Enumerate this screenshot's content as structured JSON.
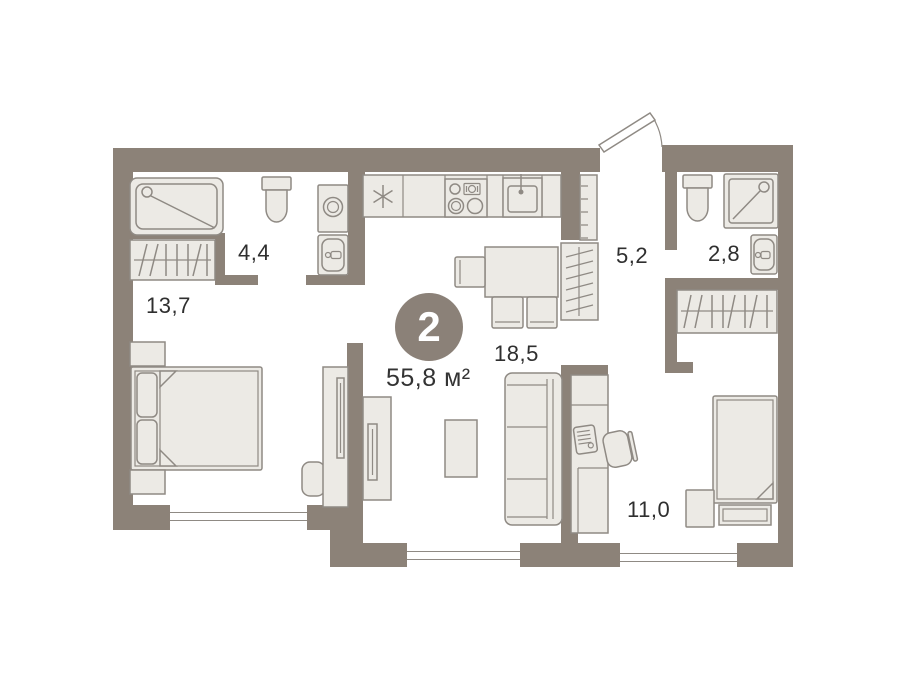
{
  "plan": {
    "badge": {
      "rooms_count": "2",
      "total_area": "55,8 м²"
    },
    "rooms": [
      {
        "id": "bedroom-1",
        "area": "13,7"
      },
      {
        "id": "bathroom-1",
        "area": "4,4"
      },
      {
        "id": "hallway",
        "area": "5,2"
      },
      {
        "id": "bathroom-2",
        "area": "2,8"
      },
      {
        "id": "living-kitchen",
        "area": "18,5"
      },
      {
        "id": "bedroom-2",
        "area": "11,0"
      }
    ],
    "icons": {
      "fridge": "snowflake-asterisk"
    },
    "colors": {
      "wall": "#8C8278",
      "furn-fill": "#ECEAE5",
      "furn-stroke": "#8F8A84",
      "badge": "#8B8178",
      "text": "#2F2F2F",
      "bg": "#FFFFFF"
    }
  }
}
